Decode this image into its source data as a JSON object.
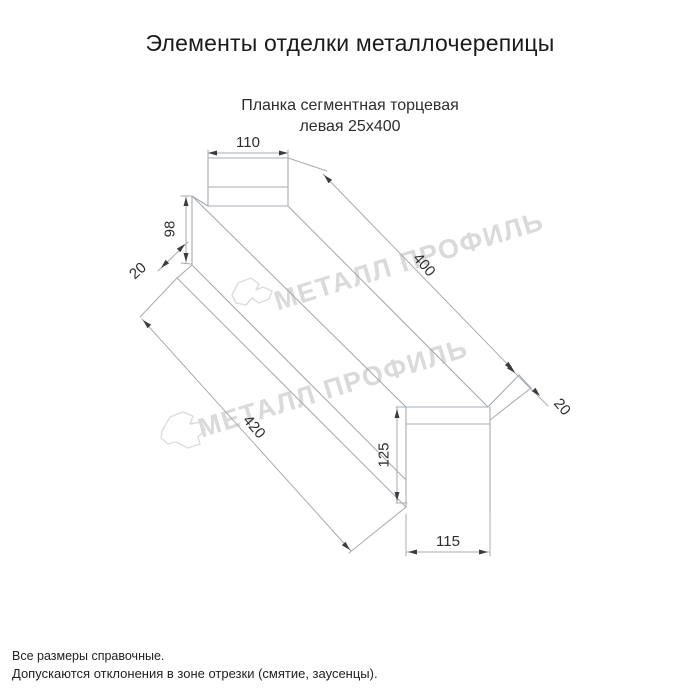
{
  "header": {
    "title": "Элементы отделки металлочерепицы",
    "subtitle_line1": "Планка сегментная торцевая",
    "subtitle_line2": "левая 25x400"
  },
  "watermark": {
    "text": "МЕТАЛЛ ПРОФИЛЬ"
  },
  "dimensions": {
    "top_flange_width": "110",
    "front_height": "98",
    "front_hem": "20",
    "length_top": "400",
    "end_hem": "20",
    "length_bottom": "420",
    "end_height": "125",
    "end_width": "115"
  },
  "footer": {
    "line1": "Все размеры справочные.",
    "line2": "Допускаются отклонения в зоне отрезки (смятие, заусенцы)."
  }
}
